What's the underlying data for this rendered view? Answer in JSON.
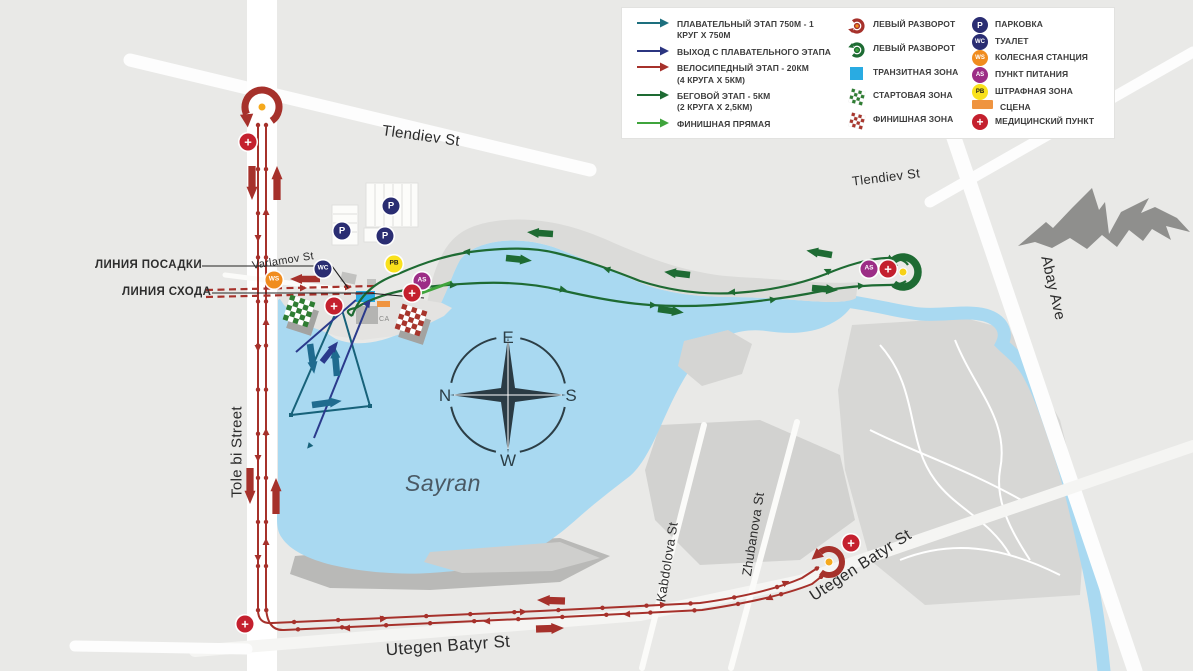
{
  "legend": {
    "route_items": [
      {
        "name": "swim-stage",
        "label": "ПЛАВАТЕЛЬНЫЙ ЭТАП 750М - 1\nКРУГ X 750М",
        "color": "#1d6f7e"
      },
      {
        "name": "swim-exit",
        "label": "ВЫХОД С ПЛАВАТЕЛЬНОГО ЭТАПА",
        "color": "#2b3580"
      },
      {
        "name": "bike-stage",
        "label": "ВЕЛОСИПЕДНЫЙ ЭТАП -  20КМ\n(4 КРУГА X 5КМ)",
        "color": "#a6312b"
      },
      {
        "name": "run-stage",
        "label": "БЕГОВОЙ ЭТАП - 5КМ\n(2 КРУГА X 2,5КМ)",
        "color": "#1e6b33"
      },
      {
        "name": "finish-straight",
        "label": "ФИНИШНАЯ ПРЯМАЯ",
        "color": "#3fa43c"
      }
    ],
    "zone_items": [
      {
        "name": "left-uturn-bike",
        "label": "ЛЕВЫЙ РАЗВОРОТ",
        "icon": "uturn-red",
        "color": "#a6312b",
        "dot": "#f08c1e"
      },
      {
        "name": "left-uturn-run",
        "label": "ЛЕВЫЙ РАЗВОРОТ",
        "icon": "uturn-green",
        "color": "#1e6b33",
        "dot": "#3fa43c"
      },
      {
        "name": "transit-zone",
        "label": "ТРАНЗИТНАЯ ЗОНА",
        "icon": "square",
        "color": "#29abe2"
      },
      {
        "name": "start-zone",
        "label": "СТАРТОВАЯ ЗОНА",
        "icon": "checker",
        "color": "#2e7d32"
      },
      {
        "name": "finish-zone",
        "label": "ФИНИШНАЯ ЗОНА",
        "icon": "checker",
        "color": "#a8352c"
      }
    ],
    "facility_items": [
      {
        "name": "parking",
        "label": "ПАРКОВКА",
        "badge": "P",
        "bg": "#2a2d72",
        "fg": "#ffffff"
      },
      {
        "name": "toilet",
        "label": "ТУАЛЕТ",
        "badge": "WC",
        "bg": "#2a2d72",
        "fg": "#ffffff"
      },
      {
        "name": "wheel-station",
        "label": "КОЛЕСНАЯ СТАНЦИЯ",
        "badge": "WS",
        "bg": "#f08c1e",
        "fg": "#ffffff"
      },
      {
        "name": "aid-station",
        "label": "ПУНКТ ПИТАНИЯ",
        "badge": "AS",
        "bg": "#9c2d86",
        "fg": "#ffffff"
      },
      {
        "name": "penalty-zone",
        "label": "ШТРАФНАЯ ЗОНА",
        "badge": "PB",
        "bg": "#f9e11c",
        "fg": "#1a1a1a"
      },
      {
        "name": "stage-scene",
        "label": "СЦЕНА",
        "badge": "",
        "bg": "#ef9440",
        "fg": "#ffffff",
        "shape": "rect"
      },
      {
        "name": "medical",
        "label": "МЕДИЦИНСКИЙ ПУНКТ",
        "badge": "+",
        "bg": "#c4202e",
        "fg": "#ffffff"
      }
    ]
  },
  "map": {
    "street_labels": [
      {
        "text": "Tlendiev St",
        "x": 421,
        "y": 136,
        "rot": 8,
        "size": 15
      },
      {
        "text": "Tlendiev St",
        "x": 886,
        "y": 177,
        "rot": -7,
        "size": 13
      },
      {
        "text": "Tole bi Street",
        "x": 237,
        "y": 452,
        "rot": -90,
        "size": 15
      },
      {
        "text": "Varlamov St",
        "x": 283,
        "y": 261,
        "rot": -9,
        "size": 11
      },
      {
        "text": "Kabdolova St",
        "x": 667,
        "y": 562,
        "rot": -81,
        "size": 13
      },
      {
        "text": "Zhubanova St",
        "x": 753,
        "y": 534,
        "rot": -81,
        "size": 13
      },
      {
        "text": "Utegen Batyr St",
        "x": 448,
        "y": 646,
        "rot": -4,
        "size": 17
      },
      {
        "text": "Utegen Batyr St",
        "x": 861,
        "y": 566,
        "rot": -33,
        "size": 16
      },
      {
        "text": "Abay Ave",
        "x": 1053,
        "y": 288,
        "rot": 77,
        "size": 15
      }
    ],
    "lake_label": "Sayran",
    "area_label": "CA",
    "callouts": [
      {
        "text": "ЛИНИЯ ПОСАДКИ"
      },
      {
        "text": "ЛИНИЯ СХОДА"
      }
    ],
    "markers": [
      {
        "type": "parking",
        "x": 391,
        "y": 206
      },
      {
        "type": "parking",
        "x": 342,
        "y": 231
      },
      {
        "type": "parking",
        "x": 385,
        "y": 236
      },
      {
        "type": "toilet",
        "x": 323,
        "y": 269
      },
      {
        "type": "penalty-zone",
        "x": 394,
        "y": 264
      },
      {
        "type": "wheel-station",
        "x": 274,
        "y": 280
      },
      {
        "type": "aid-station",
        "x": 422,
        "y": 281
      },
      {
        "type": "aid-station",
        "x": 869,
        "y": 269
      },
      {
        "type": "medical",
        "x": 248,
        "y": 142
      },
      {
        "type": "medical",
        "x": 334,
        "y": 306
      },
      {
        "type": "medical",
        "x": 412,
        "y": 293
      },
      {
        "type": "medical",
        "x": 888,
        "y": 269
      },
      {
        "type": "medical",
        "x": 851,
        "y": 543
      },
      {
        "type": "medical",
        "x": 245,
        "y": 624
      }
    ]
  },
  "compass": {
    "top": "E",
    "right": "S",
    "bottom": "W",
    "left": "N"
  }
}
